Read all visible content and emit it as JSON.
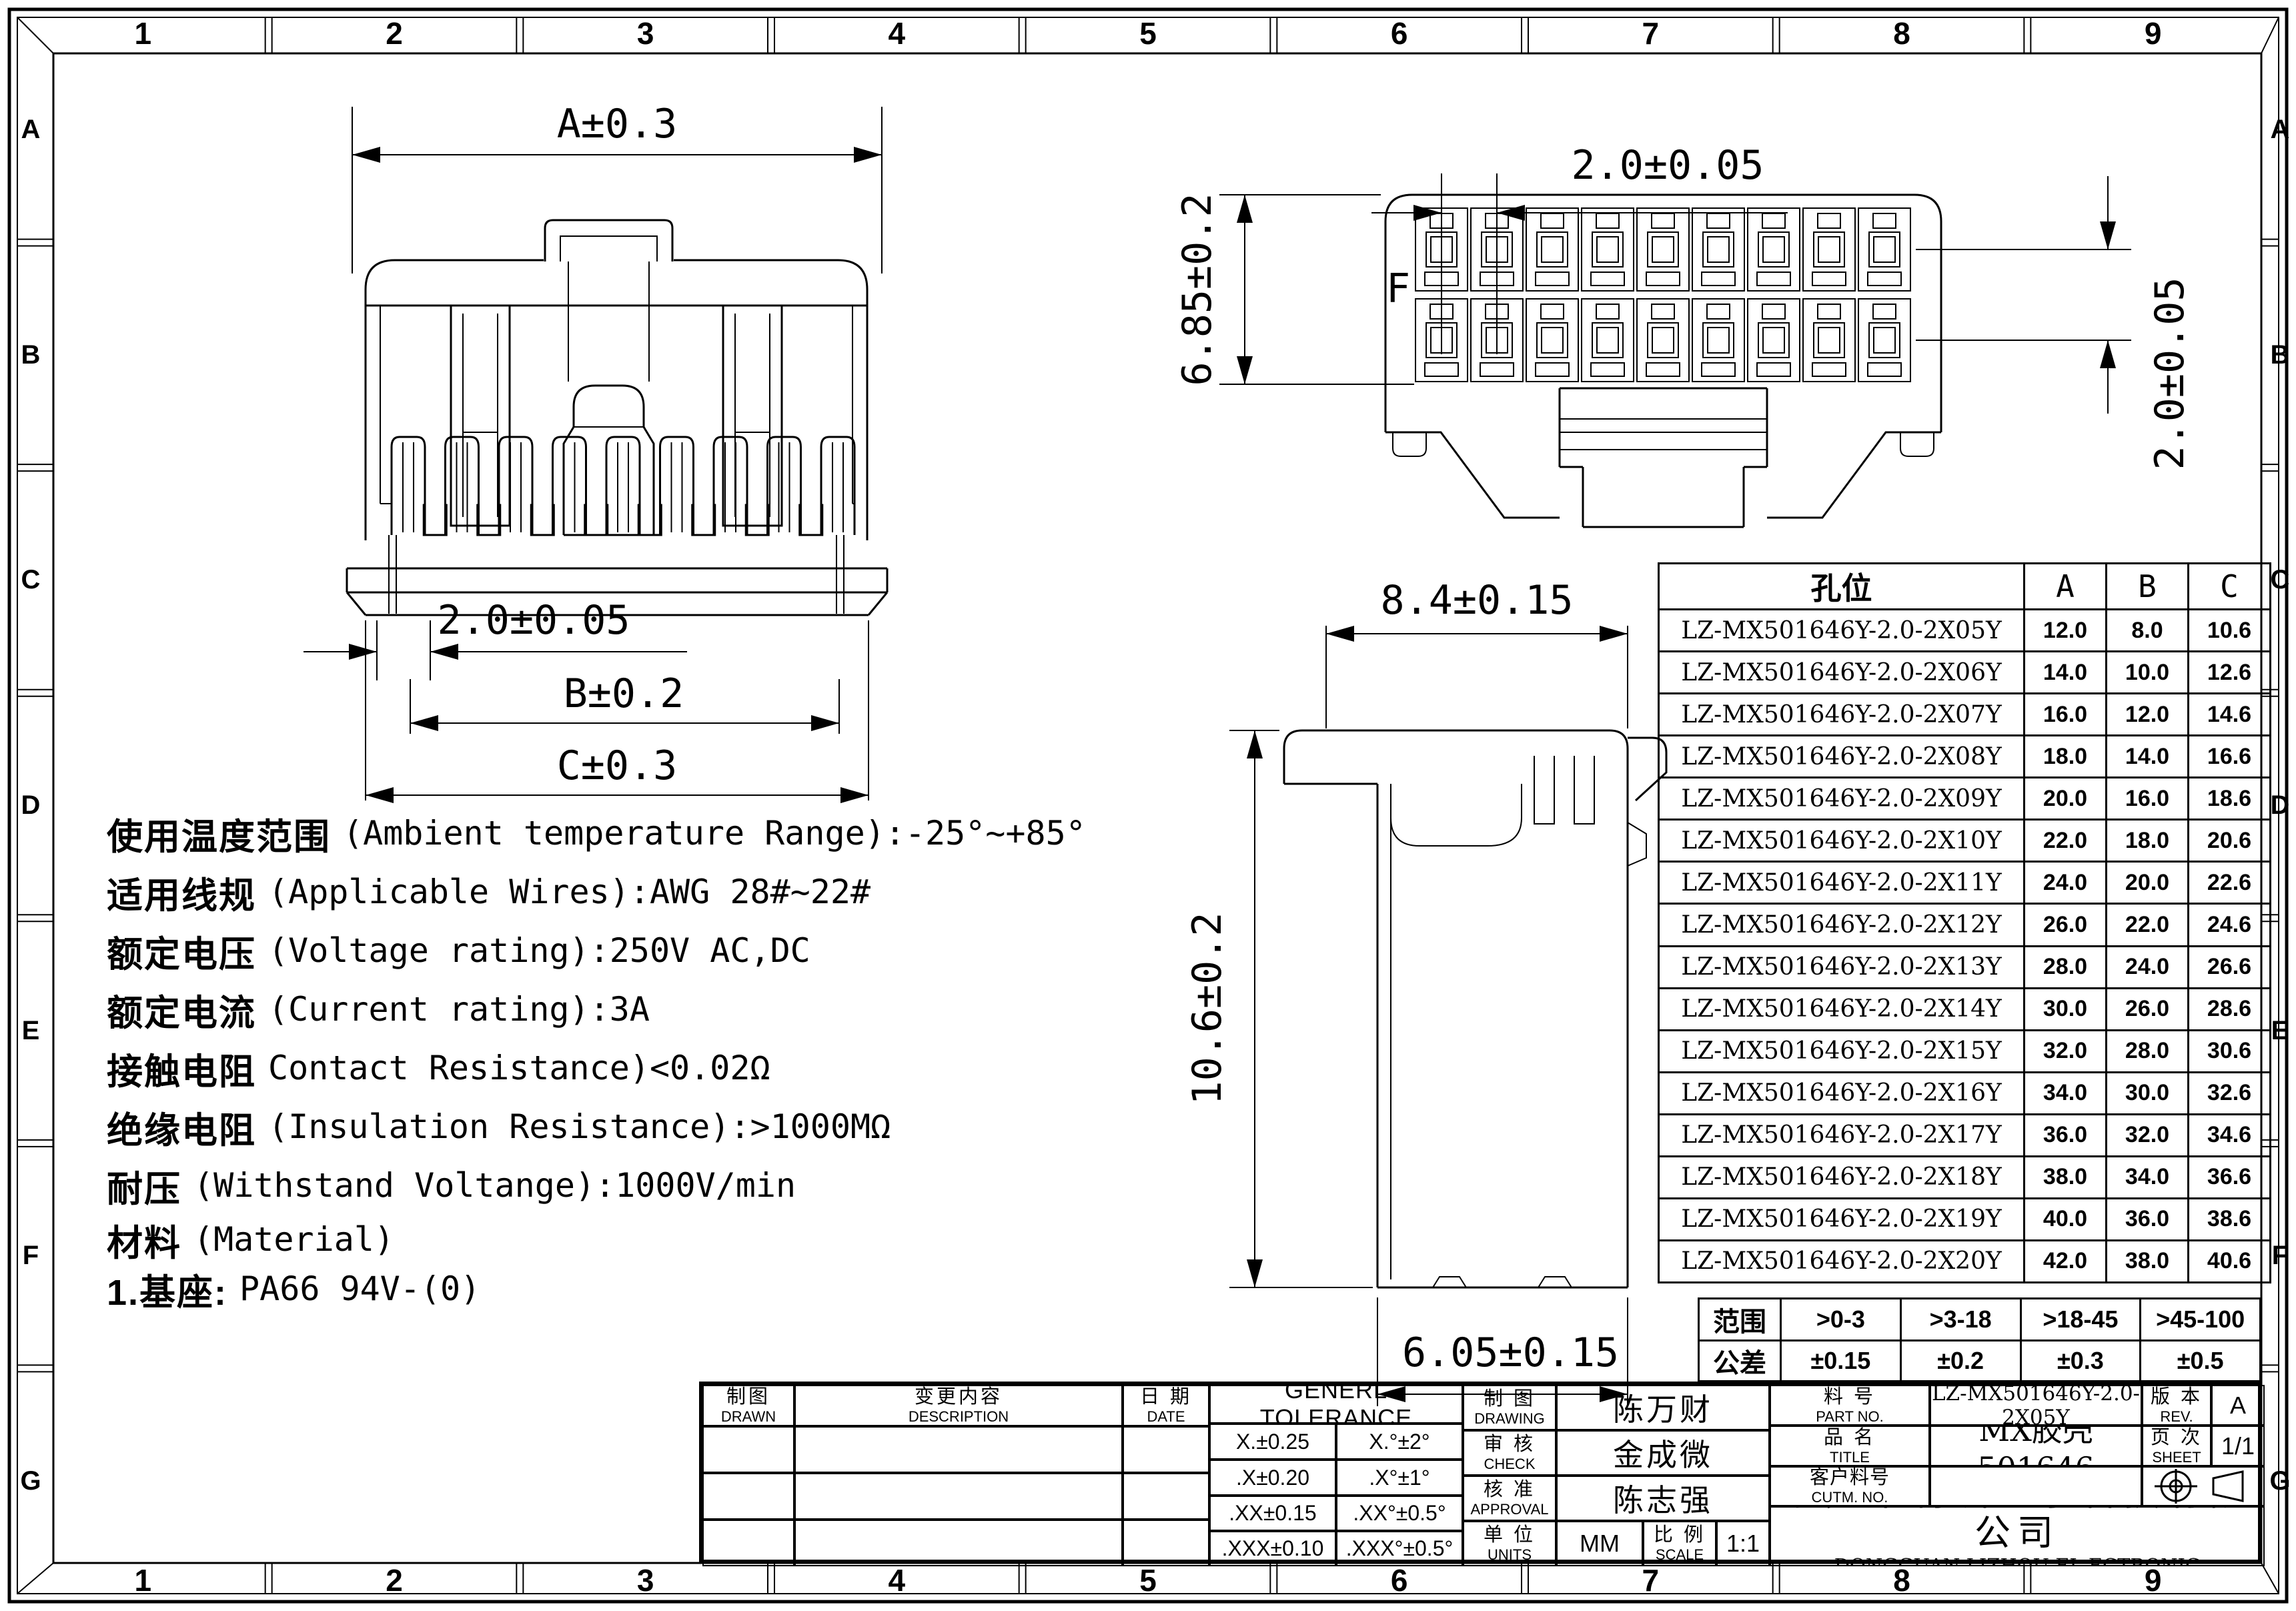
{
  "border": {
    "column_labels": [
      "1",
      "2",
      "3",
      "4",
      "5",
      "6",
      "7",
      "8",
      "9"
    ],
    "row_labels": [
      "A",
      "B",
      "C",
      "D",
      "E",
      "F",
      "G"
    ]
  },
  "views": {
    "front": {
      "dim_width": "A±0.3",
      "dim_pitch": "2.0±0.05",
      "dim_b": "B±0.2",
      "dim_c": "C±0.3"
    },
    "rear": {
      "dim_pitch_h": "2.0±0.05",
      "dim_height": "6.85±0.2",
      "dim_pitch_v": "2.0±0.05",
      "cavity_label": "F"
    },
    "side": {
      "dim_width": "8.4±0.15",
      "dim_height": "10.6±0.2",
      "dim_bottom": "6.05±0.15"
    }
  },
  "specs": {
    "lines": [
      {
        "zh": "使用温度范围",
        "en": "(Ambient temperature Range):-25°~+85°"
      },
      {
        "zh": "适用线规",
        "en": "(Applicable Wires):AWG 28#~22#"
      },
      {
        "zh": "额定电压",
        "en": "(Voltage rating):250V AC,DC"
      },
      {
        "zh": "额定电流",
        "en": "(Current rating):3A"
      },
      {
        "zh": "接触电阻",
        "en": "Contact Resistance)<0.02Ω"
      },
      {
        "zh": "绝缘电阻",
        "en": "(Insulation Resistance):>1000MΩ"
      },
      {
        "zh": "耐压",
        "en": "(Withstand Voltange):1000V/min"
      },
      {
        "zh": "材料",
        "en": "(Material)"
      },
      {
        "zh": "1.基座:",
        "en": "PA66 94V-(0)"
      }
    ]
  },
  "part_table": {
    "headers": {
      "part": "孔位",
      "a": "A",
      "b": "B",
      "c": "C"
    },
    "rows": [
      {
        "pn": "LZ-MX501646Y-2.0-2X05Y",
        "a": "12.0",
        "b": "8.0",
        "c": "10.6"
      },
      {
        "pn": "LZ-MX501646Y-2.0-2X06Y",
        "a": "14.0",
        "b": "10.0",
        "c": "12.6"
      },
      {
        "pn": "LZ-MX501646Y-2.0-2X07Y",
        "a": "16.0",
        "b": "12.0",
        "c": "14.6"
      },
      {
        "pn": "LZ-MX501646Y-2.0-2X08Y",
        "a": "18.0",
        "b": "14.0",
        "c": "16.6"
      },
      {
        "pn": "LZ-MX501646Y-2.0-2X09Y",
        "a": "20.0",
        "b": "16.0",
        "c": "18.6"
      },
      {
        "pn": "LZ-MX501646Y-2.0-2X10Y",
        "a": "22.0",
        "b": "18.0",
        "c": "20.6"
      },
      {
        "pn": "LZ-MX501646Y-2.0-2X11Y",
        "a": "24.0",
        "b": "20.0",
        "c": "22.6"
      },
      {
        "pn": "LZ-MX501646Y-2.0-2X12Y",
        "a": "26.0",
        "b": "22.0",
        "c": "24.6"
      },
      {
        "pn": "LZ-MX501646Y-2.0-2X13Y",
        "a": "28.0",
        "b": "24.0",
        "c": "26.6"
      },
      {
        "pn": "LZ-MX501646Y-2.0-2X14Y",
        "a": "30.0",
        "b": "26.0",
        "c": "28.6"
      },
      {
        "pn": "LZ-MX501646Y-2.0-2X15Y",
        "a": "32.0",
        "b": "28.0",
        "c": "30.6"
      },
      {
        "pn": "LZ-MX501646Y-2.0-2X16Y",
        "a": "34.0",
        "b": "30.0",
        "c": "32.6"
      },
      {
        "pn": "LZ-MX501646Y-2.0-2X17Y",
        "a": "36.0",
        "b": "32.0",
        "c": "34.6"
      },
      {
        "pn": "LZ-MX501646Y-2.0-2X18Y",
        "a": "38.0",
        "b": "34.0",
        "c": "36.6"
      },
      {
        "pn": "LZ-MX501646Y-2.0-2X19Y",
        "a": "40.0",
        "b": "36.0",
        "c": "38.6"
      },
      {
        "pn": "LZ-MX501646Y-2.0-2X20Y",
        "a": "42.0",
        "b": "38.0",
        "c": "40.6"
      }
    ]
  },
  "tolerance_table": {
    "range_label": "范围",
    "tol_label": "公差",
    "ranges": [
      ">0-3",
      ">3-18",
      ">18-45",
      ">45-100"
    ],
    "tolerances": [
      "±0.15",
      "±0.2",
      "±0.3",
      "±0.5"
    ]
  },
  "title_block": {
    "drawn": {
      "zh": "制图",
      "en": "DRAWN"
    },
    "description": {
      "zh": "变更内容",
      "en": "DESCRIPTION"
    },
    "date": {
      "zh": "日 期",
      "en": "DATE"
    },
    "general_tolerance": {
      "title": "GENERL TOLERANCE",
      "rows": [
        [
          "X.±0.25",
          "X.°±2°"
        ],
        [
          ".X±0.20",
          ".X°±1°"
        ],
        [
          ".XX±0.15",
          ".XX°±0.5°"
        ],
        [
          ".XXX±0.10",
          ".XXX°±0.5°"
        ]
      ]
    },
    "drawing": {
      "zh": "制 图",
      "en": "DRAWING",
      "name": "陈万财"
    },
    "check": {
      "zh": "审 核",
      "en": "CHECK",
      "name": "金成微"
    },
    "approval": {
      "zh": "核 准",
      "en": "APPROVAL",
      "name": "陈志强"
    },
    "units": {
      "zh": "单 位",
      "en": "UNITS",
      "value": "MM"
    },
    "scale": {
      "zh": "比 例",
      "en": "SCALE",
      "value": "1:1"
    },
    "part_no": {
      "zh": "料 号",
      "en": "PART NO.",
      "value": "LZ-MX501646Y-2.0-2X05Y"
    },
    "rev": {
      "zh": "版 本",
      "en": "REV.",
      "value": "A"
    },
    "title": {
      "zh": "品 名",
      "en": "TITLE",
      "value": "MX胶壳 501646"
    },
    "sheet": {
      "zh": "页 次",
      "en": "SHEET",
      "value": "1/1"
    },
    "customer_no": {
      "zh": "客户料号",
      "en": "CUTM. NO.",
      "value": ""
    },
    "company": {
      "zh": "东莞市利洲电子科技有限公司",
      "en": "DONGGUAN LIZHOU EL ECTRONIC TECHNOLOGY CO.,LID"
    }
  }
}
